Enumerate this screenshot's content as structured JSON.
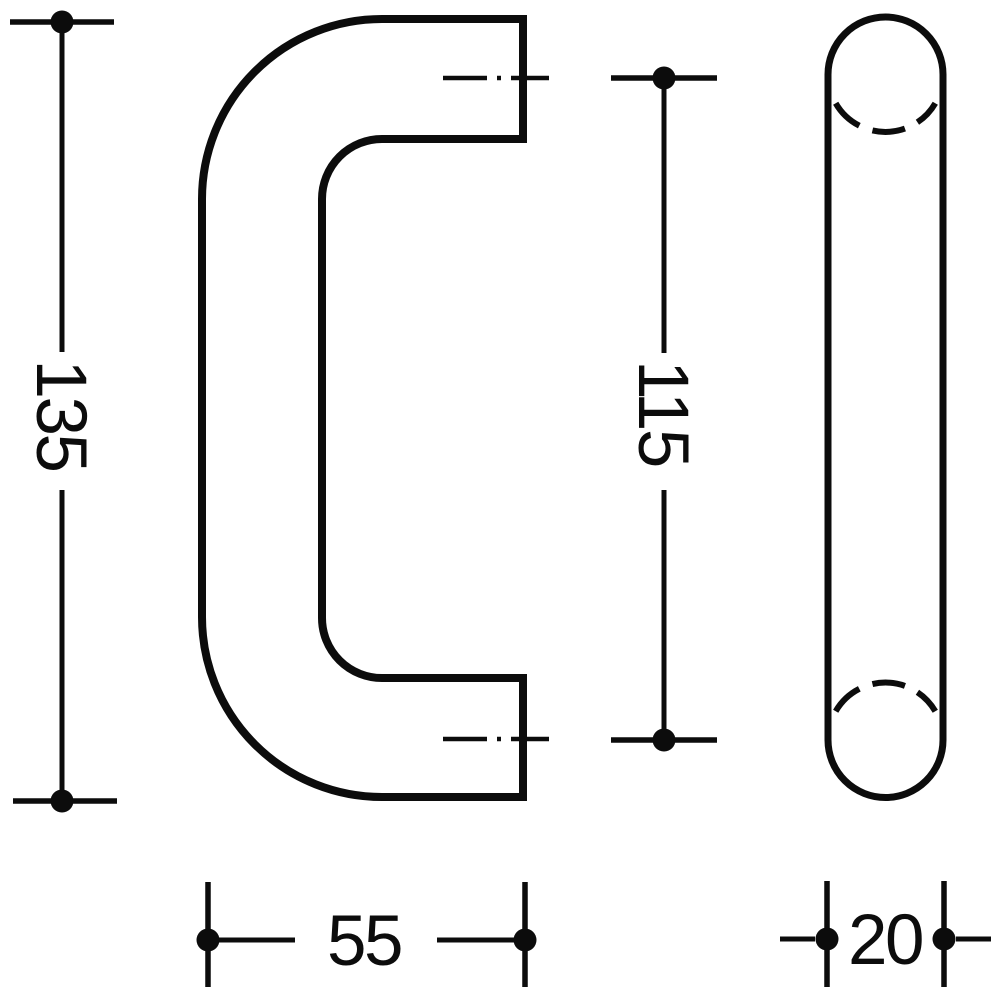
{
  "figure": {
    "colors": {
      "ink": "#0c0c0c",
      "background": "#ffffff"
    },
    "dimensions": {
      "overall_height": "135",
      "mounting_centers": "115",
      "projection": "55",
      "tube_diameter": "20"
    }
  }
}
